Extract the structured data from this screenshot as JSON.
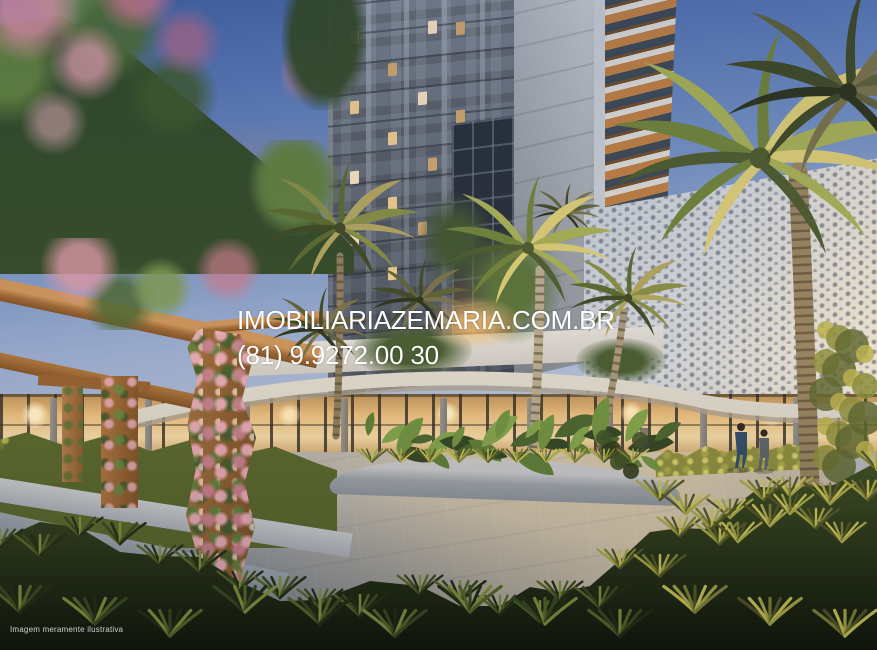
{
  "overlay": {
    "website": "IMOBILIARIAZEMARIA.COM.BR",
    "phone": "(81) 9.9272.00 30",
    "text_color": "#ffffff"
  },
  "watermark": {
    "text": "Imagem meramente ilustrativa"
  },
  "scene": {
    "subject": "residential-building-render-at-dusk",
    "accent_colors": {
      "sky_blue": "#5474b2",
      "warm_light": "#f2d9a6",
      "wood": "#a9713e",
      "flower_pink": "#d88c9e",
      "foliage_green": "#55652c"
    }
  }
}
